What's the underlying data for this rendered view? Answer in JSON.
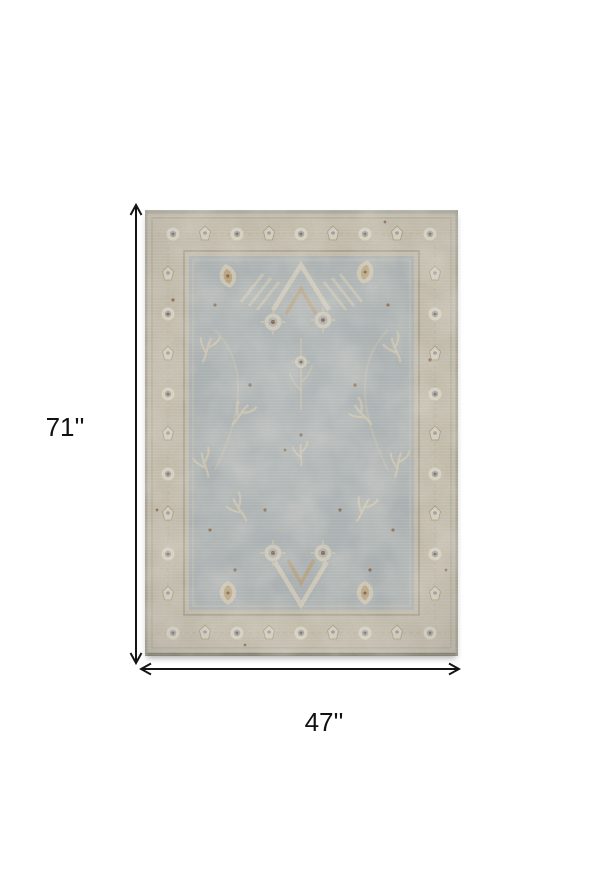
{
  "page": {
    "background_color": "#ffffff"
  },
  "dimensions": {
    "height_label": "71''",
    "width_label": "47''",
    "arrow_color": "#141414",
    "label_color": "#111111"
  },
  "product_image": {
    "kind": "area-rug-photo",
    "colors": {
      "border_beige": "#c3bcab",
      "field_blue_gray": "#a8b0b3",
      "motif_cream": "#d6cfbb",
      "motif_tan": "#b49a6e",
      "accent_brown": "#7c5332",
      "accent_slate": "#8e99a3",
      "guard_line": "#9a9383"
    }
  }
}
